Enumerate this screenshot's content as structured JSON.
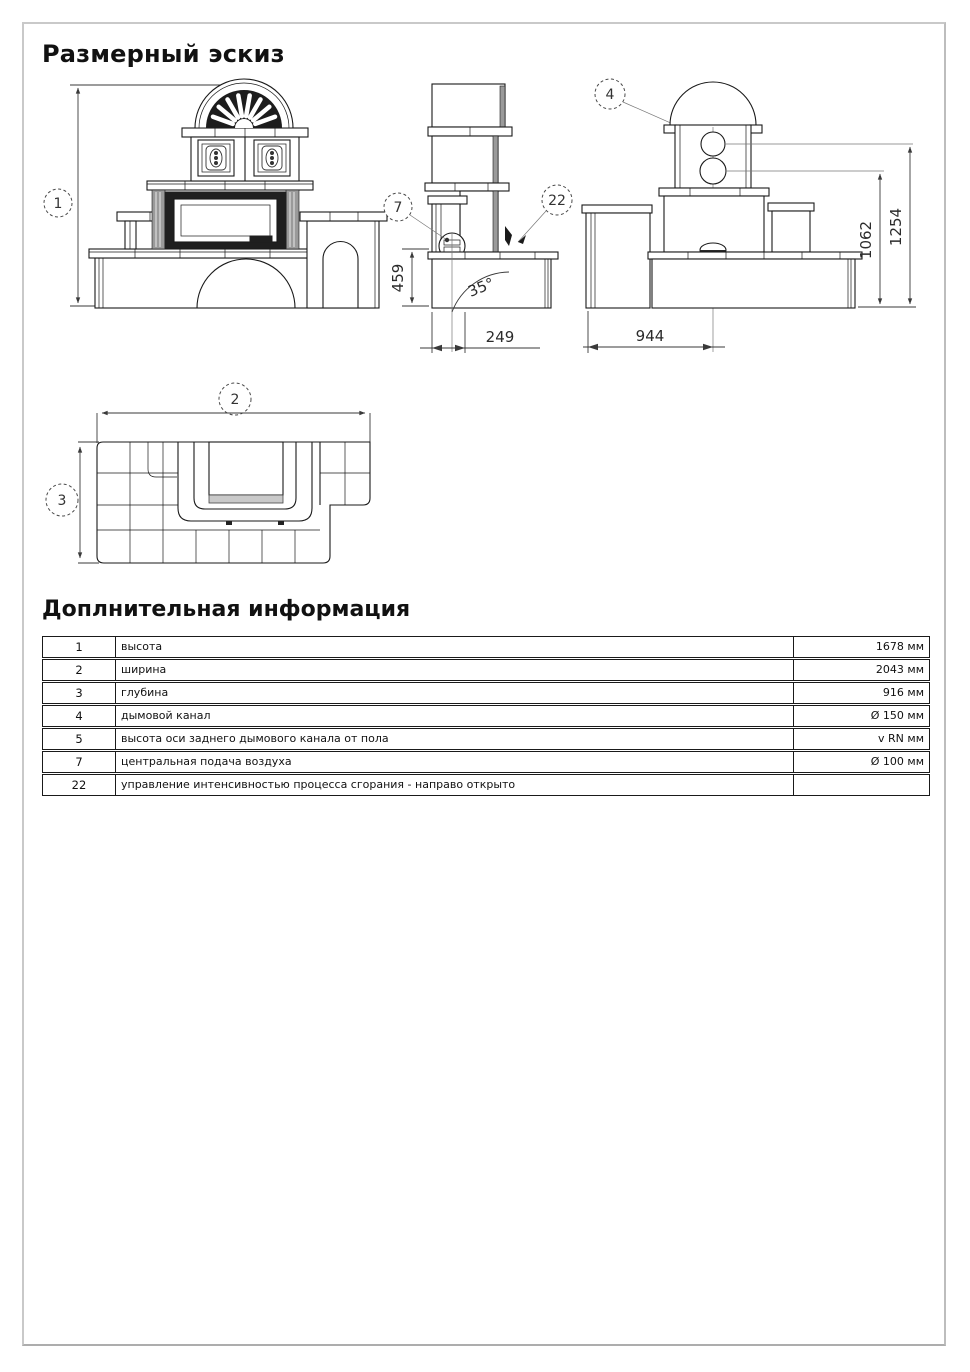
{
  "page": {
    "title": "Размерный эскиз",
    "info_title": "Доплнительная информация"
  },
  "drawing": {
    "callouts": {
      "height": "1",
      "width": "2",
      "depth": "3",
      "smoke_channel": "4",
      "air_supply": "7",
      "combustion_control": "22"
    },
    "dims": {
      "bench_height": "459",
      "angle": "35°",
      "front_depth": "249",
      "rear_width": "944",
      "axis_lower": "1062",
      "axis_upper": "1254"
    }
  },
  "table": {
    "rows": [
      {
        "num": "1",
        "desc": "высота",
        "value": "1678 мм"
      },
      {
        "num": "2",
        "desc": "ширина",
        "value": "2043 мм"
      },
      {
        "num": "3",
        "desc": "глубина",
        "value": "916 мм"
      },
      {
        "num": "4",
        "desc": "дымовой канал",
        "value": "Ø 150 мм"
      },
      {
        "num": "5",
        "desc": "высота оси заднего дымового канала от пола",
        "value": "v RN мм"
      },
      {
        "num": "7",
        "desc": "центральная подача воздуха",
        "value": "Ø 100 мм"
      },
      {
        "num": "22",
        "desc": "управление интенсивностью процесса сгорания - направо открыто",
        "value": ""
      }
    ]
  }
}
